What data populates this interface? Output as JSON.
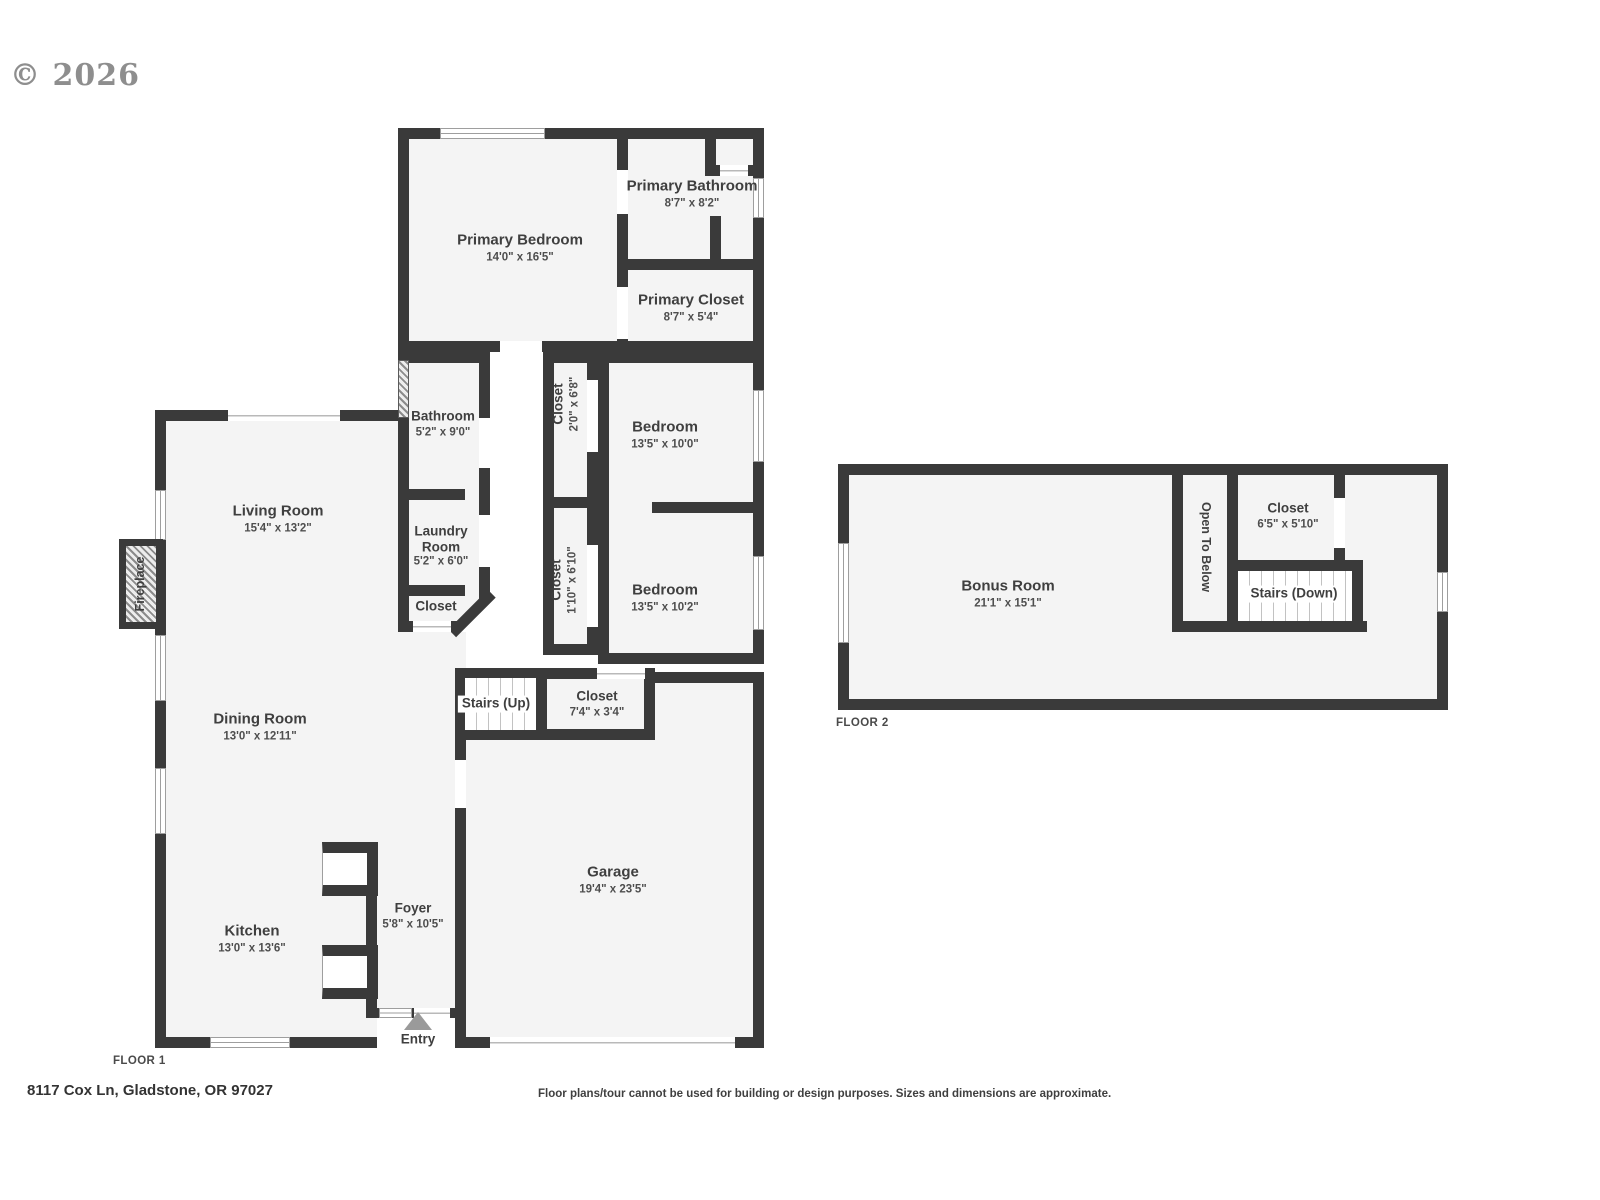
{
  "watermark": "© 2026",
  "address": "8117 Cox Ln, Gladstone, OR 97027",
  "disclaimer": "Floor plans/tour cannot be used for building or design purposes. Sizes and dimensions are approximate.",
  "colors": {
    "wall": "#3a3a3a",
    "room_fill": "#f4f4f4",
    "label_text": "#3f3f3f",
    "entry_arrow": "#9a9a9a",
    "watermark": "#8e8e8e"
  },
  "floor1": {
    "label": "FLOOR 1",
    "rooms": {
      "primary_bedroom": {
        "name": "Primary Bedroom",
        "dims": "14'0\" x 16'5\""
      },
      "primary_bathroom": {
        "name": "Primary Bathroom",
        "dims": "8'7\" x 8'2\""
      },
      "primary_closet": {
        "name": "Primary Closet",
        "dims": "8'7\" x 5'4\""
      },
      "bathroom": {
        "name": "Bathroom",
        "dims": "5'2\" x 9'0\""
      },
      "closet_a": {
        "name": "Closet",
        "dims": "2'0\" x 6'8\""
      },
      "bedroom_1": {
        "name": "Bedroom",
        "dims": "13'5\" x 10'0\""
      },
      "living_room": {
        "name": "Living Room",
        "dims": "15'4\" x 13'2\""
      },
      "laundry_room": {
        "name": "Laundry Room",
        "dims": "5'2\" x 6'0\""
      },
      "laundry_closet": {
        "name": "Closet"
      },
      "closet_b": {
        "name": "Closet",
        "dims": "1'10\" x 6'10\""
      },
      "bedroom_2": {
        "name": "Bedroom",
        "dims": "13'5\" x 10'2\""
      },
      "dining_room": {
        "name": "Dining Room",
        "dims": "13'0\" x 12'11\""
      },
      "stairs_up": {
        "name": "Stairs (Up)"
      },
      "hall_closet": {
        "name": "Closet",
        "dims": "7'4\" x 3'4\""
      },
      "kitchen": {
        "name": "Kitchen",
        "dims": "13'0\" x 13'6\""
      },
      "foyer": {
        "name": "Foyer",
        "dims": "5'8\" x 10'5\""
      },
      "garage": {
        "name": "Garage",
        "dims": "19'4\" x 23'5\""
      },
      "entry": {
        "name": "Entry"
      },
      "fireplace": {
        "name": "Fireplace"
      }
    }
  },
  "floor2": {
    "label": "FLOOR 2",
    "rooms": {
      "bonus_room": {
        "name": "Bonus Room",
        "dims": "21'1\" x 15'1\""
      },
      "open_to_below": {
        "name": "Open To Below"
      },
      "closet": {
        "name": "Closet",
        "dims": "6'5\" x 5'10\""
      },
      "stairs_down": {
        "name": "Stairs (Down)"
      }
    }
  }
}
